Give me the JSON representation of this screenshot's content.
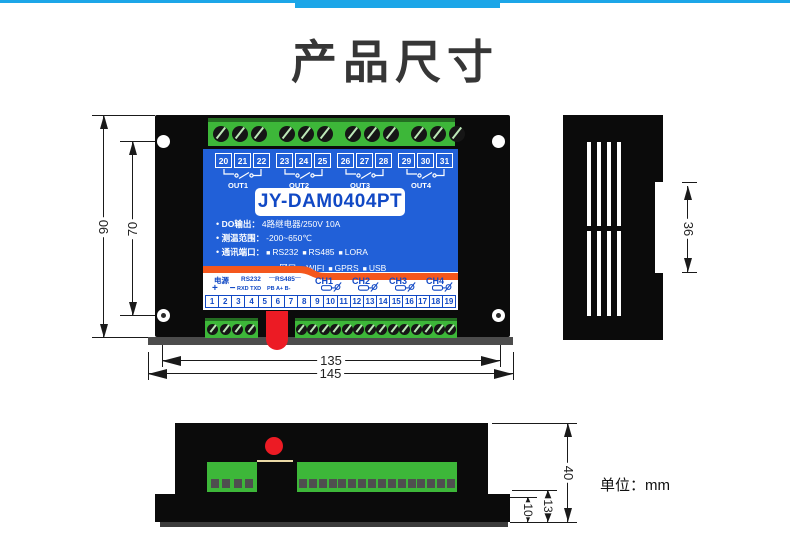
{
  "header": {
    "title": "产品尺寸"
  },
  "front": {
    "model": "JY-DAM0404PT",
    "out_groups": [
      {
        "nums": [
          "20",
          "21",
          "22"
        ],
        "label": "OUT1"
      },
      {
        "nums": [
          "23",
          "24",
          "25"
        ],
        "label": "OUT2"
      },
      {
        "nums": [
          "26",
          "27",
          "28"
        ],
        "label": "OUT3"
      },
      {
        "nums": [
          "29",
          "30",
          "31"
        ],
        "label": "OUT4"
      }
    ],
    "specs": {
      "line1_label": "DO输出：",
      "line1_value": "4路继电器/250V 10A",
      "line2_label": "测温范围：",
      "line2_value": "-200~650℃",
      "line3_label": "通讯端口：",
      "line3_items": [
        "RS232",
        "RS485",
        "LORA"
      ],
      "line4_items": [
        "网口",
        "WIFI",
        "GPRS",
        "USB"
      ]
    },
    "io": {
      "power_label": "电源",
      "power_pins": "+ −",
      "rs232_label": "RS232",
      "rs232_pins": "RXD TXD",
      "rs485_label": "RS485",
      "rs485_pins": "PB A+ B-",
      "channels": [
        "CH1",
        "CH2",
        "CH3",
        "CH4"
      ],
      "numbers": [
        "1",
        "2",
        "3",
        "4",
        "5",
        "6",
        "7",
        "8",
        "9",
        "10",
        "11",
        "12",
        "13",
        "14",
        "15",
        "16",
        "17",
        "18",
        "19"
      ]
    }
  },
  "dimensions": {
    "height_outer": "90",
    "height_inner": "70",
    "width_inner": "135",
    "width_outer": "145",
    "side_tab": "36",
    "bottom_height": "40",
    "bottom_step": "13",
    "bottom_flange": "10"
  },
  "footer": {
    "unit": "单位：mm"
  },
  "colors": {
    "accent_cyan": "#1ca6e8",
    "panel_blue": "#2160d8",
    "label_blue": "#1149c5",
    "terminal_green": "#3db739",
    "stripe_orange": "#f4571d",
    "usb_red": "#ec1b24"
  }
}
